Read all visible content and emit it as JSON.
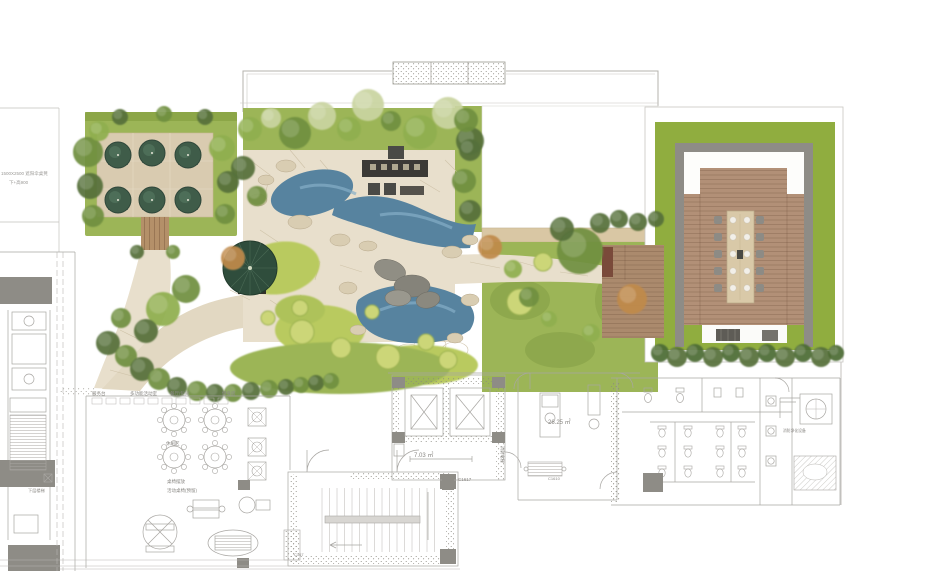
{
  "plan": {
    "type": "rooftop-landscape-plan",
    "palette": {
      "lawn": "#9cb557",
      "lawn_light": "#b9ca5e",
      "terrace_stone": "#e8dfcc",
      "courtyard_paving": "#d9cbb0",
      "water": "#57839f",
      "water_light": "#84aec7",
      "wood_deck": "#b29077",
      "boardwalk": "#b49069",
      "pavilion_lawn": "#90ad3f",
      "structure_dark": "#3c3a36",
      "parasol_green": "#2f4d3c",
      "cad_line": "#a8a6a2",
      "column_gray": "#8e8c86",
      "boundary": "#b5b3ae"
    }
  },
  "annotations": {
    "left_note_line1": "1500X2500 遮阳伞桌凳",
    "left_note_line2": "下+高900",
    "label_service": "服务台",
    "label_multi": "多功能活动室",
    "label_dining": "餐厅/包间",
    "label_gym": "健身房",
    "label_lounge": "休闲区",
    "label_tables1": "桌椅摆放",
    "label_tables2": "活动桌椅(预留)",
    "label_stairs_lower": "下层楼梯",
    "elevator_area": "7.03 ㎡",
    "office_area": "26.25 ㎡",
    "code_c1617": "C1617",
    "code_c1610": "C1610",
    "code_c167": "C167",
    "fire_elevator": "消防电梯",
    "purification": "消防净化设备"
  },
  "tree_colors": [
    "#6f8f3e",
    "#8fae4e",
    "#55703a",
    "#c9d4a0",
    "#c08a4a",
    "#4c6b33"
  ],
  "shapes": {
    "trees": [
      [
        88,
        152,
        15,
        0
      ],
      [
        90,
        186,
        13,
        2
      ],
      [
        93,
        216,
        11,
        0
      ],
      [
        99,
        131,
        10,
        1
      ],
      [
        120,
        117,
        8,
        2
      ],
      [
        164,
        114,
        8,
        0
      ],
      [
        205,
        117,
        8,
        2
      ],
      [
        222,
        148,
        13,
        1
      ],
      [
        228,
        182,
        11,
        2
      ],
      [
        225,
        214,
        10,
        0
      ],
      [
        137,
        252,
        7,
        2
      ],
      [
        173,
        252,
        7,
        0
      ],
      [
        250,
        129,
        12,
        1
      ],
      [
        271,
        118,
        10,
        3
      ],
      [
        295,
        133,
        16,
        0
      ],
      [
        322,
        116,
        14,
        3
      ],
      [
        349,
        129,
        12,
        1
      ],
      [
        368,
        105,
        16,
        3
      ],
      [
        391,
        121,
        10,
        0
      ],
      [
        420,
        132,
        17,
        1
      ],
      [
        448,
        113,
        16,
        3
      ],
      [
        470,
        141,
        14,
        2
      ],
      [
        243,
        168,
        12,
        2
      ],
      [
        257,
        196,
        10,
        0
      ],
      [
        233,
        258,
        12,
        4
      ],
      [
        186,
        289,
        14,
        0
      ],
      [
        163,
        309,
        17,
        1
      ],
      [
        146,
        331,
        12,
        2
      ],
      [
        121,
        318,
        10,
        0
      ],
      [
        108,
        343,
        12,
        2
      ],
      [
        126,
        356,
        11,
        0
      ],
      [
        142,
        369,
        12,
        2
      ],
      [
        159,
        379,
        11,
        0
      ],
      [
        177,
        387,
        10,
        2
      ],
      [
        197,
        391,
        10,
        0
      ],
      [
        215,
        393,
        9,
        2
      ],
      [
        233,
        393,
        9,
        0
      ],
      [
        251,
        391,
        9,
        2
      ],
      [
        269,
        389,
        9,
        0
      ],
      [
        286,
        387,
        8,
        2
      ],
      [
        301,
        385,
        8,
        0
      ],
      [
        316,
        383,
        8,
        2
      ],
      [
        331,
        381,
        8,
        0
      ],
      [
        466,
        120,
        12,
        0
      ],
      [
        470,
        150,
        11,
        2
      ],
      [
        464,
        181,
        12,
        0
      ],
      [
        470,
        211,
        11,
        2
      ],
      [
        490,
        247,
        12,
        4
      ],
      [
        513,
        269,
        9,
        1
      ],
      [
        529,
        297,
        10,
        0
      ],
      [
        549,
        319,
        8,
        1
      ],
      [
        580,
        251,
        23,
        0
      ],
      [
        562,
        229,
        12,
        2
      ],
      [
        600,
        223,
        10,
        2
      ],
      [
        619,
        219,
        9,
        2
      ],
      [
        638,
        222,
        9,
        2
      ],
      [
        656,
        219,
        8,
        2
      ],
      [
        632,
        299,
        15,
        4
      ],
      [
        591,
        333,
        9,
        1
      ],
      [
        660,
        353,
        9,
        5
      ],
      [
        677,
        357,
        10,
        2
      ],
      [
        695,
        353,
        9,
        5
      ],
      [
        713,
        357,
        10,
        2
      ],
      [
        731,
        353,
        9,
        5
      ],
      [
        749,
        357,
        10,
        2
      ],
      [
        767,
        353,
        9,
        5
      ],
      [
        785,
        357,
        10,
        2
      ],
      [
        803,
        353,
        9,
        5
      ],
      [
        821,
        357,
        10,
        2
      ],
      [
        836,
        353,
        8,
        5
      ]
    ],
    "shrubs": [
      [
        302,
        332,
        12
      ],
      [
        341,
        348,
        10
      ],
      [
        388,
        357,
        12
      ],
      [
        426,
        342,
        8
      ],
      [
        448,
        360,
        9
      ],
      [
        520,
        302,
        13
      ],
      [
        543,
        262,
        9
      ],
      [
        300,
        308,
        8
      ],
      [
        268,
        318,
        7
      ],
      [
        372,
        312,
        7
      ]
    ],
    "umbrellas": [
      [
        118,
        155
      ],
      [
        152,
        153
      ],
      [
        188,
        155
      ],
      [
        118,
        200
      ],
      [
        152,
        200
      ],
      [
        188,
        200
      ]
    ],
    "dining_rows_y": [
      220,
      237,
      254,
      271,
      288
    ],
    "round_tables": [
      [
        174,
        420
      ],
      [
        215,
        420
      ],
      [
        174,
        457
      ],
      [
        215,
        457
      ]
    ],
    "planters": [
      [
        248,
        408
      ],
      [
        248,
        438
      ],
      [
        248,
        462
      ]
    ],
    "toilets": [
      [
        662,
        432
      ],
      [
        662,
        452
      ],
      [
        662,
        472
      ],
      [
        688,
        432
      ],
      [
        688,
        452
      ],
      [
        688,
        472
      ],
      [
        720,
        432
      ],
      [
        720,
        452
      ],
      [
        720,
        472
      ],
      [
        742,
        432
      ],
      [
        742,
        452
      ],
      [
        742,
        472
      ]
    ],
    "stair_treads": {
      "x0": 322,
      "x1": 440,
      "step": 7.5,
      "y0": 488,
      "y1": 552
    }
  }
}
